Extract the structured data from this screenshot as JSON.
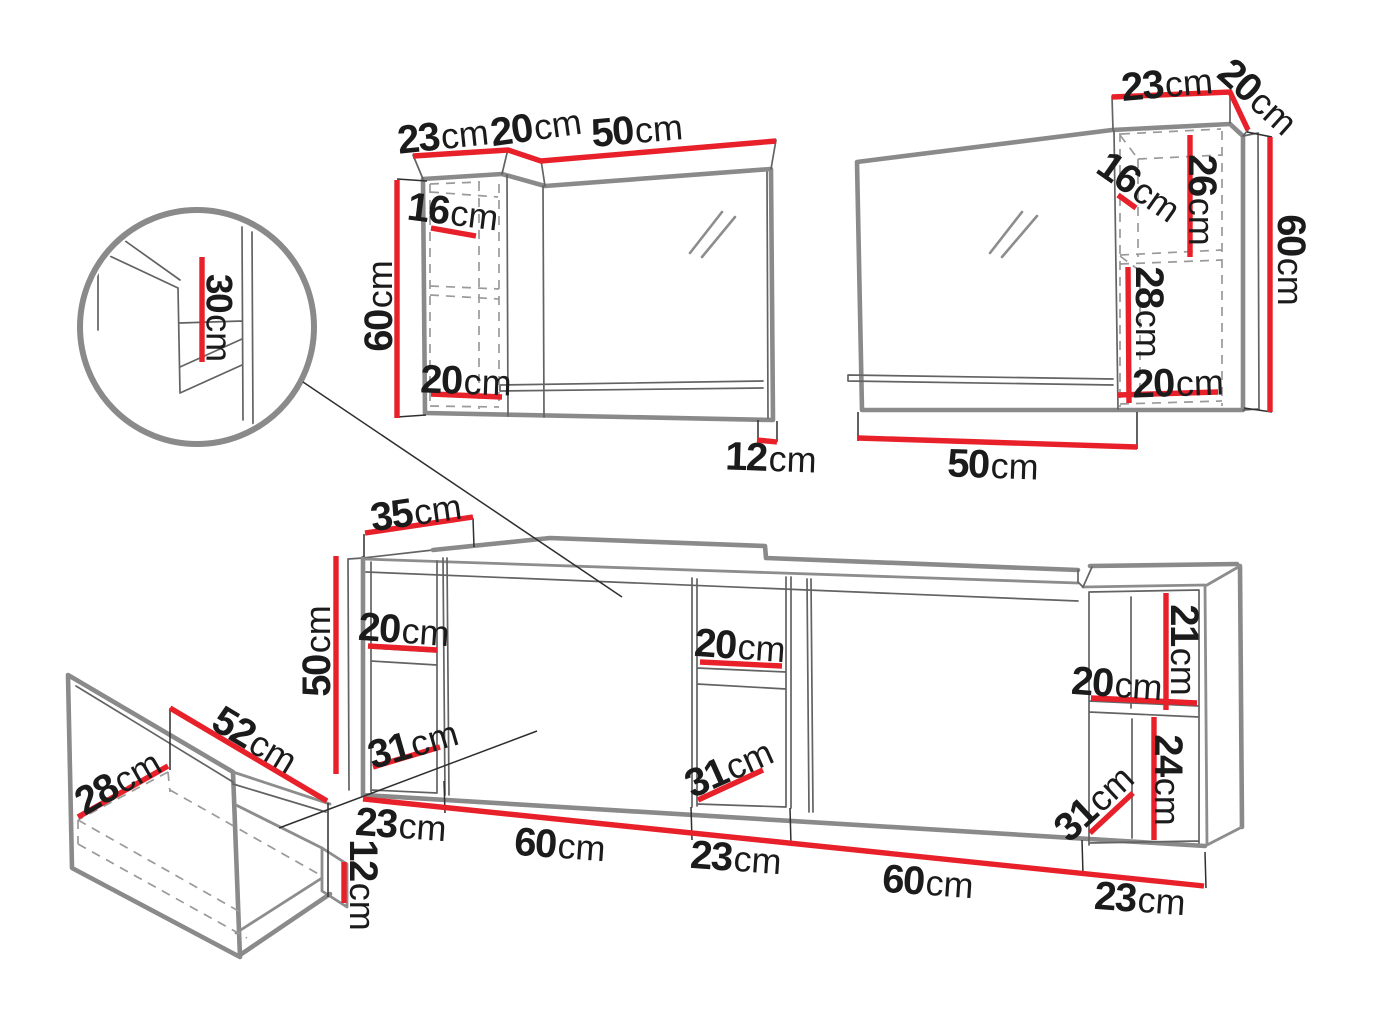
{
  "colors": {
    "dim-red": "#e8202a",
    "line-gray": "#8a8a8a",
    "text": "#1b1b1b"
  },
  "components": {
    "wall_cabinet_left": {
      "dims": {
        "top_depth": {
          "num": "23",
          "unit": "cm"
        },
        "top_side": {
          "num": "20",
          "unit": "cm"
        },
        "top_width": {
          "num": "50",
          "unit": "cm"
        },
        "inner_shelf_depth": {
          "num": "16",
          "unit": "cm"
        },
        "height": {
          "num": "60",
          "unit": "cm"
        },
        "inner_bottom": {
          "num": "20",
          "unit": "cm"
        },
        "mirror_overhang": {
          "num": "12",
          "unit": "cm"
        }
      }
    },
    "wall_cabinet_right": {
      "dims": {
        "top_depth": {
          "num": "23",
          "unit": "cm"
        },
        "top_side": {
          "num": "20",
          "unit": "cm"
        },
        "inner_shelf_depth": {
          "num": "16",
          "unit": "cm"
        },
        "inner_upper_height": {
          "num": "26",
          "unit": "cm"
        },
        "inner_lower_height": {
          "num": "28",
          "unit": "cm"
        },
        "inner_bottom": {
          "num": "20",
          "unit": "cm"
        },
        "height": {
          "num": "60",
          "unit": "cm"
        },
        "mirror_width": {
          "num": "50",
          "unit": "cm"
        }
      }
    },
    "corner_detail": {
      "dims": {
        "inner_depth": {
          "num": "30",
          "unit": "cm"
        }
      }
    },
    "base_cabinet": {
      "dims": {
        "top_depth": {
          "num": "35",
          "unit": "cm"
        },
        "height": {
          "num": "50",
          "unit": "cm"
        },
        "left_shelf_width": {
          "num": "20",
          "unit": "cm"
        },
        "left_opening": {
          "num": "31",
          "unit": "cm"
        },
        "middle_shelf_width": {
          "num": "20",
          "unit": "cm"
        },
        "middle_opening": {
          "num": "31",
          "unit": "cm"
        },
        "right_upper_height": {
          "num": "21",
          "unit": "cm"
        },
        "right_shelf_width": {
          "num": "20",
          "unit": "cm"
        },
        "right_lower_height": {
          "num": "24",
          "unit": "cm"
        },
        "right_opening": {
          "num": "31",
          "unit": "cm"
        },
        "width_1": {
          "num": "23",
          "unit": "cm"
        },
        "width_2": {
          "num": "60",
          "unit": "cm"
        },
        "width_3": {
          "num": "23",
          "unit": "cm"
        },
        "width_4": {
          "num": "60",
          "unit": "cm"
        },
        "width_5": {
          "num": "23",
          "unit": "cm"
        }
      }
    },
    "drawer_detail": {
      "dims": {
        "back_height": {
          "num": "28",
          "unit": "cm"
        },
        "width": {
          "num": "52",
          "unit": "cm"
        },
        "front_height": {
          "num": "12",
          "unit": "cm"
        }
      }
    }
  }
}
